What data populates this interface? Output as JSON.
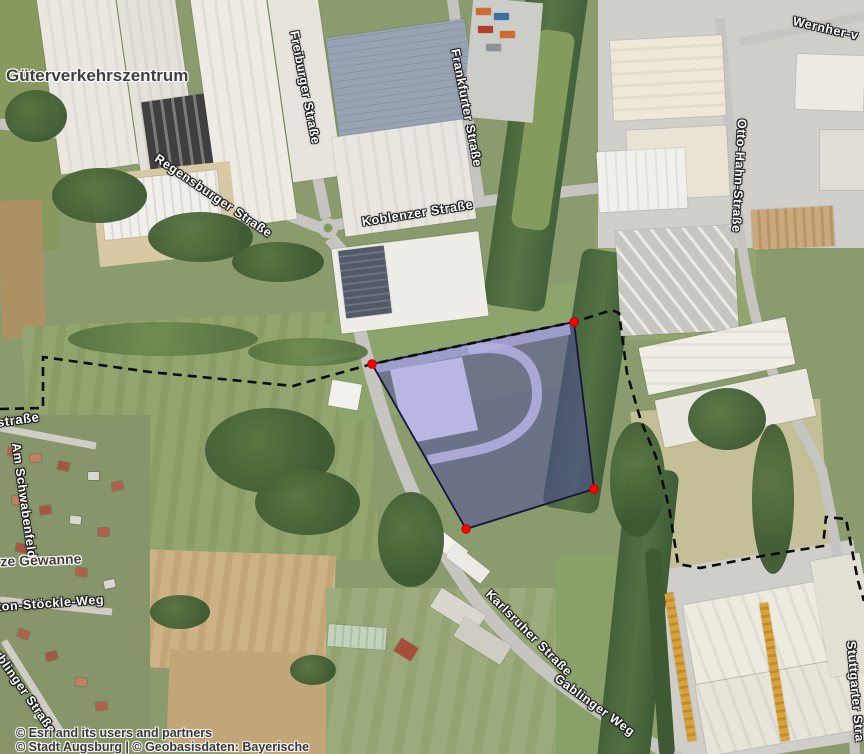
{
  "map": {
    "street_labels": [
      {
        "text": "Freiburger Straße"
      },
      {
        "text": "Frankfurter Straße"
      },
      {
        "text": "Regensburger Straße"
      },
      {
        "text": "Koblenzer Straße"
      },
      {
        "text": "Wernher-v"
      },
      {
        "text": "Otto-Hahn-Straße"
      },
      {
        "text": "Karlsruher Straße"
      },
      {
        "text": "Gablinger Weg"
      },
      {
        "text": "Am Schwabenfeld"
      },
      {
        "text": "straße"
      },
      {
        "text": "ton-Stöckle-Weg"
      },
      {
        "text": "rblinger Straße"
      },
      {
        "text": "Stuttgarter Stra"
      }
    ],
    "place_labels": [
      {
        "text": "Güterverkehrszentrum"
      },
      {
        "text": "rze Gewanne"
      }
    ],
    "attribution": [
      {
        "text": "© Esri and its users and partners"
      },
      {
        "text": "© Stadt Augsburg | © Geobasisdaten: Bayerische"
      }
    ],
    "parcel": {
      "fill_color": "#4f4aa0",
      "fill_opacity": "0.52",
      "outline_color": "#15153d",
      "vertex_color": "#ff0000",
      "points": "372,364 574,322 594,489 466,529",
      "vertices": [
        {
          "x": "372",
          "y": "364"
        },
        {
          "x": "574",
          "y": "322"
        },
        {
          "x": "594",
          "y": "489"
        },
        {
          "x": "466",
          "y": "529"
        }
      ],
      "building_highlight_points": "390,370 462,357 478,430 406,444",
      "ramp_path": "M468,350 C515,342 536,360 537,392 C538,424 512,444 468,452 L428,460",
      "top_band_path": "M374,368 L570,329",
      "boundary_path": "M0,409 L43,408 L43,357 L150,372 L293,386 L372,364 L574,322 L612,310 L619,313 L627,373 L641,421 L656,457 L669,507 L678,564 L700,568 L762,556 L823,546 L826,517 L846,519 L858,581 L864,601"
    }
  }
}
